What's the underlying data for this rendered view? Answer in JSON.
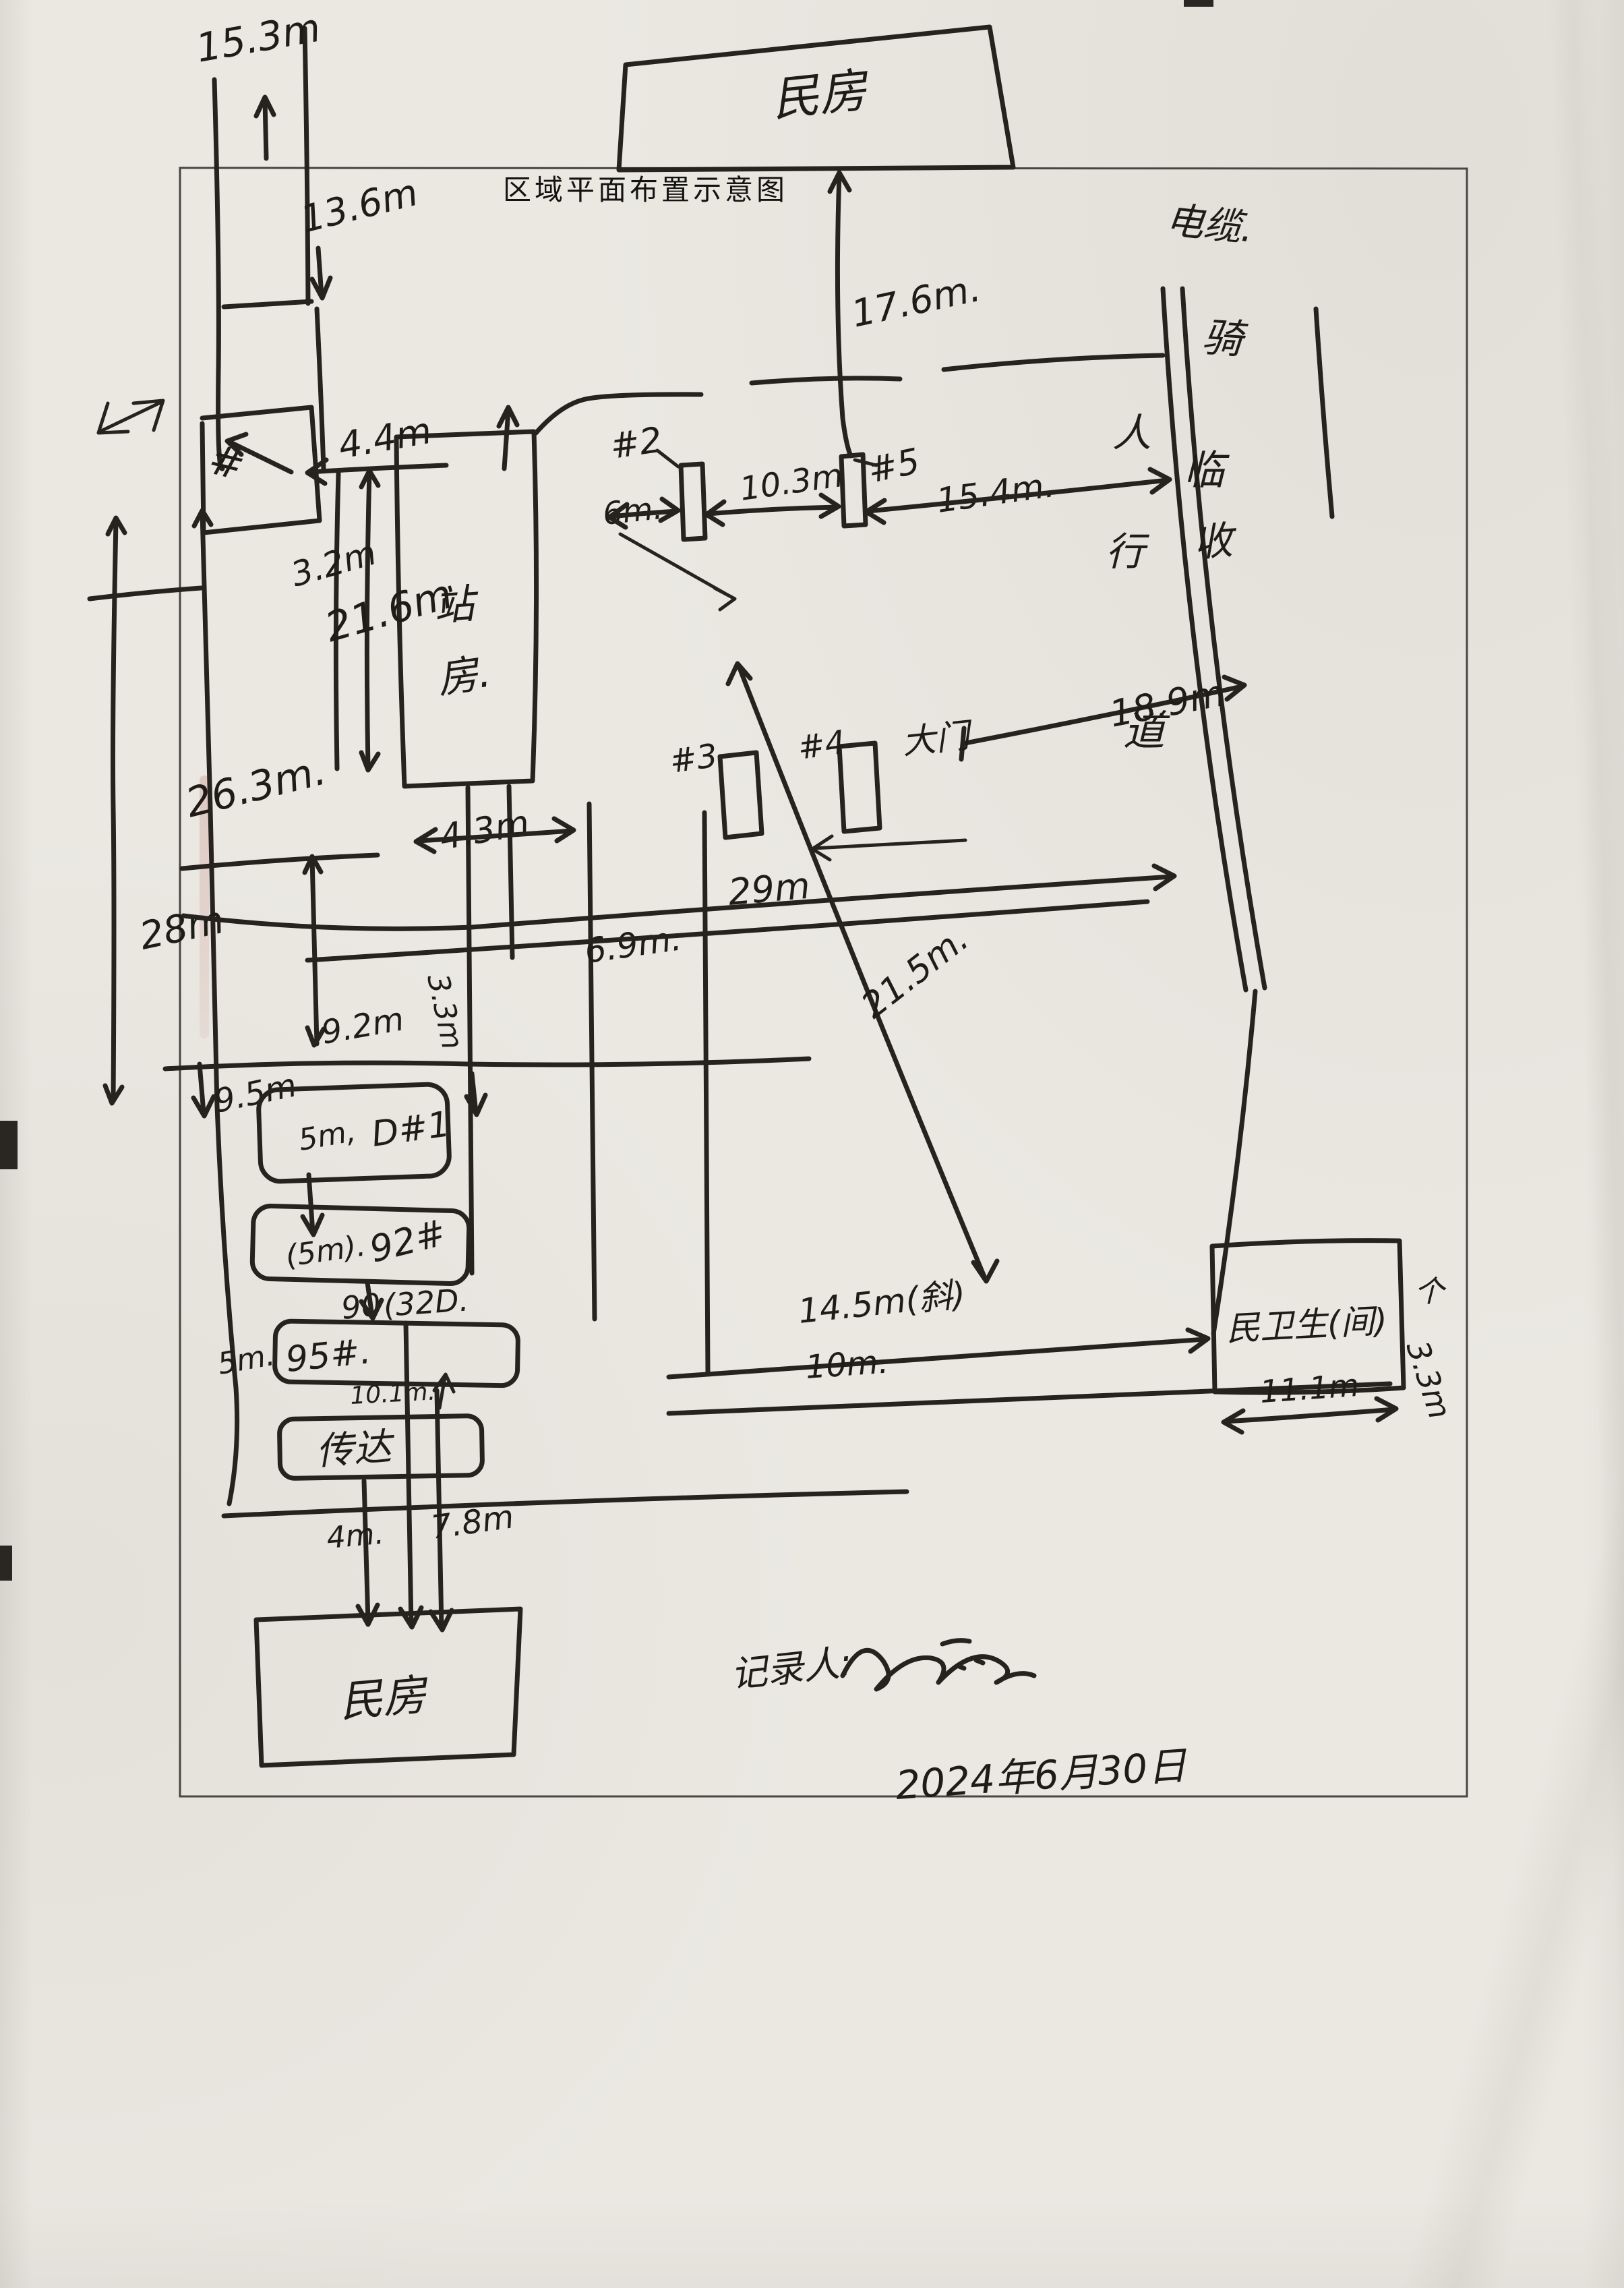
{
  "title": "区域平面布置示意图",
  "buildings": {
    "top_house": "民房",
    "station_1": "站",
    "station_2": "房.",
    "reception": "传达",
    "bottom_house": "民房",
    "toilet": "民卫生(间)",
    "gate": "大门"
  },
  "roadside": {
    "cable": "电缆.",
    "col_1": "骑",
    "col_2": "临",
    "col_3": "收",
    "walk_1": "人",
    "walk_2": "行",
    "walk_3": "道"
  },
  "poles": {
    "p2": "#2",
    "p5": "#5",
    "p3": "#3",
    "p4": "#4",
    "d1": "D#1",
    "p92": "92#",
    "p95": "95#.",
    "n90": "90",
    "n32d": "(32D.",
    "hash_tl": "#"
  },
  "dims": {
    "m153": "15.3m",
    "m136": "13.6m",
    "m176": "17.6m.",
    "m44": "4.4m",
    "m6": "6m.",
    "m103": "10.3m",
    "m154": "15.4m.",
    "m189": "18.9m",
    "m32": "3.2m",
    "m216": "21.6m",
    "m263": "26.3m.",
    "m28": "28m",
    "m43": "4.3m",
    "m69": "6.9m.",
    "m33a": "3.3m",
    "m29": "29m",
    "m215": "21.5m.",
    "m92": "9.2m",
    "m95": "9.5m",
    "m5a": "5m,",
    "m5b": "(5m).",
    "m5c": "5m.",
    "m101": "10.1m.",
    "m145": "14.5m(斜)",
    "m10": "10m.",
    "m111": "11.1m",
    "m33b": "3.3m",
    "up_glyph": "个",
    "m4": "4m.",
    "m78": "7.8m"
  },
  "footer": {
    "recorder_label": "记录人:",
    "date": "2024年6月30日"
  }
}
